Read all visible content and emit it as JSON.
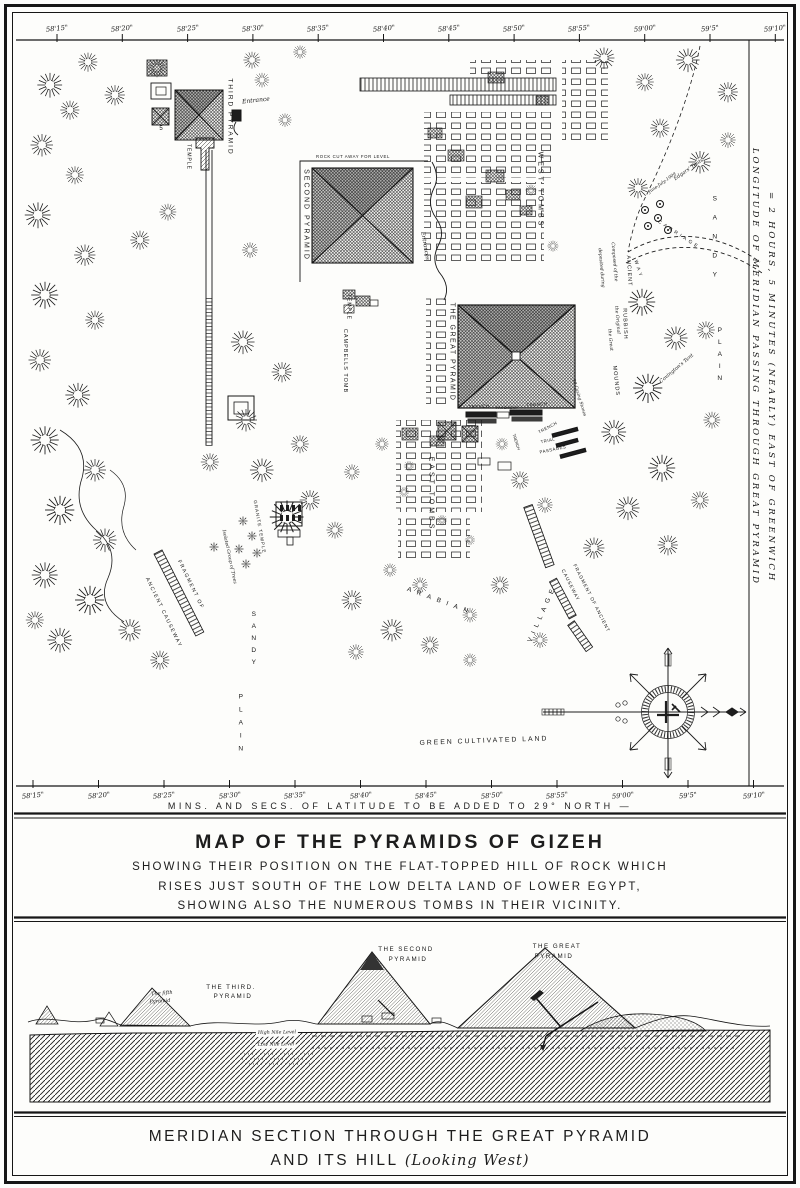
{
  "map_panel": {
    "ticks": [
      "58'15\"",
      "58'20\"",
      "58'25\"",
      "58'30\"",
      "58'35\"",
      "58'40\"",
      "58'45\"",
      "58'50\"",
      "58'55\"",
      "59'00\"",
      "59'5\"",
      "59'10\""
    ],
    "bottom_caption": "MINS. AND SECS. OF LATITUDE TO BE ADDED TO 29° NORTH —",
    "right_margin_line1": "LONGITUDE OF MERIDIAN PASSING THROUGH GREAT PYRAMID",
    "right_margin_line2": "= 2 HOURS, 5 MINUTES (NEARLY) EAST OF GREENWICH",
    "labels": [
      {
        "id": "third-pyramid",
        "text": "THIRD PYRAMID",
        "x": 229,
        "y": 117,
        "r": 90,
        "s": 6.5,
        "sp": 2,
        "cls": "caps"
      },
      {
        "id": "entrance",
        "text": "Entrance",
        "x": 256,
        "y": 101,
        "r": -6,
        "s": 6,
        "cls": "it"
      },
      {
        "id": "third-temple",
        "text": "TEMPLE",
        "x": 188,
        "y": 157,
        "r": 90,
        "s": 5,
        "sp": 1,
        "cls": "caps"
      },
      {
        "id": "small-pyramid-5",
        "text": "5",
        "x": 161,
        "y": 129,
        "r": 0,
        "s": 6,
        "cls": "caps"
      },
      {
        "id": "second-pyramid",
        "text": "SECOND PYRAMID",
        "x": 306,
        "y": 215,
        "r": 90,
        "s": 7,
        "sp": 2,
        "cls": "caps"
      },
      {
        "id": "rock-cut",
        "text": "ROCK CUT AWAY FOR LEVEL",
        "x": 353,
        "y": 157,
        "r": 0,
        "s": 4.3,
        "sp": 0.6,
        "cls": "caps"
      },
      {
        "id": "entrances",
        "text": "Entrances",
        "x": 424,
        "y": 246,
        "r": 80,
        "s": 5.5,
        "cls": "it"
      },
      {
        "id": "second-temple",
        "text": "TEMPLE",
        "x": 348,
        "y": 307,
        "r": 90,
        "s": 5,
        "sp": 1,
        "cls": "caps"
      },
      {
        "id": "great-pyramid",
        "text": "THE GREAT PYRAMID",
        "x": 452,
        "y": 352,
        "r": 90,
        "s": 7,
        "sp": 1.5,
        "cls": "caps"
      },
      {
        "id": "west-tombs",
        "text": "WEST TOMBS",
        "x": 540,
        "y": 190,
        "r": 90,
        "s": 7,
        "sp": 3,
        "cls": "caps"
      },
      {
        "id": "east-tombs",
        "text": "EAST TOMBS",
        "x": 431,
        "y": 494,
        "r": 90,
        "s": 7,
        "sp": 3,
        "cls": "caps"
      },
      {
        "id": "campbells-tomb",
        "text": "CAMPBELLS TOMB",
        "x": 344,
        "y": 361,
        "r": 90,
        "s": 5.5,
        "sp": 1,
        "cls": "caps"
      },
      {
        "id": "trench-w",
        "text": "TRENCH",
        "x": 479,
        "y": 407,
        "r": -3,
        "s": 4.3,
        "sp": 0.5,
        "cls": "caps"
      },
      {
        "id": "pavement",
        "text": "PAVEMENT",
        "x": 507,
        "y": 409,
        "r": 0,
        "s": 3.8,
        "sp": 0.3,
        "cls": "caps"
      },
      {
        "id": "trench-e",
        "text": "TRENCH",
        "x": 537,
        "y": 405,
        "r": -4,
        "s": 4.3,
        "sp": 0.5,
        "cls": "caps"
      },
      {
        "id": "trench-diag",
        "text": "TRENCH",
        "x": 548,
        "y": 428,
        "r": -28,
        "s": 4.3,
        "sp": 0.5,
        "cls": "caps"
      },
      {
        "id": "trench-vert",
        "text": "TRENCH",
        "x": 516,
        "y": 442,
        "r": 72,
        "s": 4,
        "cls": "caps"
      },
      {
        "id": "trial",
        "text": "TRIAL",
        "x": 548,
        "y": 441,
        "r": -12,
        "s": 4.3,
        "sp": 0.5,
        "cls": "caps"
      },
      {
        "id": "passages",
        "text": "PASSAGES",
        "x": 553,
        "y": 450,
        "r": -12,
        "s": 4.3,
        "sp": 0.5,
        "cls": "caps"
      },
      {
        "id": "ancient",
        "text": "ANCIENT",
        "x": 628,
        "y": 271,
        "r": 87,
        "s": 5.5,
        "sp": 1,
        "cls": "caps"
      },
      {
        "id": "rubbish",
        "text": "RUBBISH",
        "x": 624,
        "y": 324,
        "r": 88,
        "s": 5.5,
        "sp": 1,
        "cls": "caps"
      },
      {
        "id": "mounds",
        "text": "MOUNDS",
        "x": 615,
        "y": 381,
        "r": 84,
        "s": 5.5,
        "sp": 1,
        "cls": "caps"
      },
      {
        "id": "composed",
        "text": "Composed of the",
        "x": 613,
        "y": 262,
        "r": 85,
        "s": 4.6,
        "cls": "it"
      },
      {
        "id": "deposited",
        "text": "deposited during",
        "x": 600,
        "y": 268,
        "r": 85,
        "s": 4.6,
        "cls": "it"
      },
      {
        "id": "original",
        "text": "the Original",
        "x": 616,
        "y": 320,
        "r": 85,
        "s": 4.6,
        "cls": "it"
      },
      {
        "id": "the-great",
        "text": "the Great",
        "x": 609,
        "y": 340,
        "r": 85,
        "s": 4.6,
        "cls": "it"
      },
      {
        "id": "casing-stones",
        "text": "19 Casing Stones",
        "x": 578,
        "y": 398,
        "r": 73,
        "s": 4.4,
        "cls": "it"
      },
      {
        "id": "edgars-tents",
        "text": "Edgars' Tents",
        "x": 689,
        "y": 170,
        "r": -35,
        "s": 5,
        "cls": "it"
      },
      {
        "id": "edgars-date",
        "text": "June-July-1909",
        "x": 663,
        "y": 184,
        "r": -35,
        "s": 4.4,
        "cls": "it"
      },
      {
        "id": "carriage",
        "text": "CARRIAGE",
        "x": 678,
        "y": 236,
        "r": 33,
        "s": 4.8,
        "sp": 3,
        "cls": "caps"
      },
      {
        "id": "way",
        "text": "WAY",
        "x": 637,
        "y": 270,
        "r": 72,
        "s": 4.8,
        "sp": 3,
        "cls": "caps"
      },
      {
        "id": "covingtons-tent",
        "text": "Covington's Tent",
        "x": 677,
        "y": 369,
        "r": -40,
        "s": 5,
        "cls": "it"
      },
      {
        "id": "granite-temple",
        "text": "GRANITE TEMPLE",
        "x": 259,
        "y": 527,
        "r": 80,
        "s": 4.6,
        "sp": 1,
        "cls": "caps"
      },
      {
        "id": "isolated-trees",
        "text": "Isolated Group of Trees",
        "x": 228,
        "y": 557,
        "r": 78,
        "s": 4.6,
        "cls": "it"
      },
      {
        "id": "fragment-of-w",
        "text": "FRAGMENT OF",
        "x": 190,
        "y": 585,
        "r": 64,
        "s": 5.2,
        "sp": 1.5,
        "cls": "caps"
      },
      {
        "id": "ancient-causeway-w",
        "text": "ANCIENT CAUSEWAY",
        "x": 163,
        "y": 613,
        "r": 64,
        "s": 5.2,
        "sp": 1.5,
        "cls": "caps"
      },
      {
        "id": "fragment-of-e",
        "text": "FRAGMENT OF ANCIENT",
        "x": 590,
        "y": 599,
        "r": 63,
        "s": 4.8,
        "sp": 1,
        "cls": "caps"
      },
      {
        "id": "causeway-e",
        "text": "CAUSEWAY",
        "x": 569,
        "y": 586,
        "r": 63,
        "s": 4.8,
        "sp": 1,
        "cls": "caps"
      },
      {
        "id": "sandy-w",
        "text": "SANDY",
        "x": 253,
        "y": 641,
        "r": 0,
        "s": 6.5,
        "sp": 5,
        "cls": "caps vu"
      },
      {
        "id": "plain-w",
        "text": "PLAIN",
        "x": 240,
        "y": 726,
        "r": 0,
        "s": 6.5,
        "sp": 6,
        "cls": "caps vu"
      },
      {
        "id": "sandy-e",
        "text": "SANDY",
        "x": 714,
        "y": 243,
        "r": 0,
        "s": 6.5,
        "sp": 12,
        "cls": "caps vu"
      },
      {
        "id": "plain-e",
        "text": "PLAIN",
        "x": 719,
        "y": 357,
        "r": 0,
        "s": 6.5,
        "sp": 5,
        "cls": "caps vu"
      },
      {
        "id": "arabian",
        "text": "ARABIAN",
        "x": 440,
        "y": 602,
        "r": 20,
        "s": 6.5,
        "sp": 6,
        "cls": "caps"
      },
      {
        "id": "village",
        "text": "VILLAGE",
        "x": 543,
        "y": 614,
        "r": -66,
        "s": 6.5,
        "sp": 5,
        "cls": "caps"
      },
      {
        "id": "green-cultivated-land",
        "text": "GREEN CULTIVATED LAND",
        "x": 484,
        "y": 742,
        "r": -2,
        "s": 6.8,
        "sp": 2,
        "cls": "caps"
      }
    ]
  },
  "title_block": {
    "title": "MAP OF THE PYRAMIDS OF GIZEH",
    "sub1": "SHOWING THEIR POSITION ON THE FLAT-TOPPED HILL OF ROCK WHICH",
    "sub2": "RISES JUST SOUTH OF THE LOW DELTA LAND OF LOWER EGYPT,",
    "sub3": "SHOWING ALSO THE NUMEROUS TOMBS IN THEIR VICINITY."
  },
  "section_panel": {
    "labels": [
      {
        "id": "fifth-pyramid-1",
        "text": "The fifth",
        "x": 162,
        "y": 994,
        "r": -4,
        "s": 5,
        "cls": "it"
      },
      {
        "id": "fifth-pyramid-2",
        "text": "Pyramid",
        "x": 160,
        "y": 1002,
        "r": -4,
        "s": 5,
        "cls": "it"
      },
      {
        "id": "third-pyramid-1",
        "text": "THE THIRD.",
        "x": 231,
        "y": 988,
        "r": 0,
        "s": 6.2,
        "sp": 1.5,
        "cls": "caps"
      },
      {
        "id": "third-pyramid-2",
        "text": "PYRAMID",
        "x": 233,
        "y": 997,
        "r": 0,
        "s": 6.2,
        "sp": 1.5,
        "cls": "caps"
      },
      {
        "id": "second-pyramid-1",
        "text": "THE SECOND",
        "x": 406,
        "y": 950,
        "r": 0,
        "s": 6.2,
        "sp": 1.5,
        "cls": "caps"
      },
      {
        "id": "second-pyramid-2",
        "text": "PYRAMID",
        "x": 408,
        "y": 960,
        "r": 0,
        "s": 6.2,
        "sp": 1.5,
        "cls": "caps"
      },
      {
        "id": "great-pyramid-1",
        "text": "THE GREAT",
        "x": 557,
        "y": 947,
        "r": 0,
        "s": 6.2,
        "sp": 1.5,
        "cls": "caps"
      },
      {
        "id": "great-pyramid-2",
        "text": "PYRAMID",
        "x": 554,
        "y": 957,
        "r": 0,
        "s": 6.2,
        "sp": 1.5,
        "cls": "caps"
      },
      {
        "id": "high-nile-level",
        "text": "High Nile Level",
        "x": 277,
        "y": 1034,
        "r": -1,
        "s": 4.8,
        "cls": "it bg"
      },
      {
        "id": "low-nile-level",
        "text": "Low Nile Level",
        "x": 276,
        "y": 1046,
        "r": -1,
        "s": 4.8,
        "cls": "it bg"
      }
    ]
  },
  "caption_block": {
    "line1": "MERIDIAN SECTION THROUGH THE GREAT PYRAMID",
    "line2a": "AND ITS HILL",
    "line2b": "(Looking West)"
  },
  "colors": {
    "ink": "#1d1d1d",
    "paper": "#fdfdfb"
  }
}
